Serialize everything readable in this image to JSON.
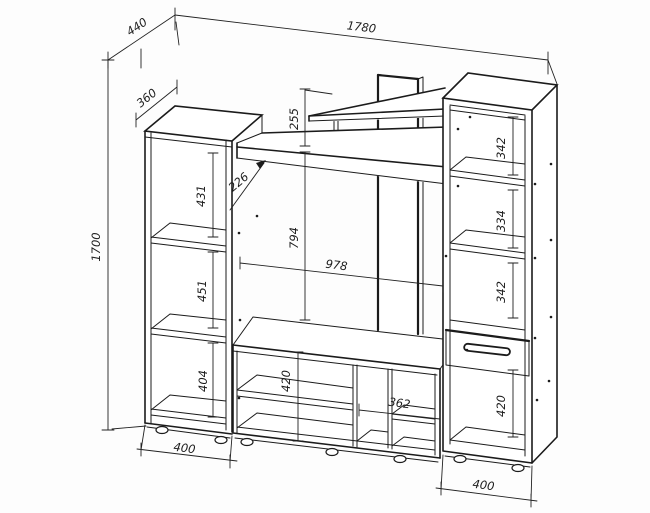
{
  "drawing": {
    "type": "furniture-assembly-dimension-drawing",
    "units": "mm",
    "line_color": "#1b1b1b",
    "background": "#fdfdfd",
    "dims": {
      "overall_width": "1780",
      "overall_depth": "440",
      "overall_height": "1700",
      "left_top_depth": "360",
      "left_shelf_1": "431",
      "left_shelf_2": "451",
      "left_shelf_3": "404",
      "left_base_width": "400",
      "shelf_gap": "255",
      "shelf_depth": "226",
      "tv_opening_height": "794",
      "tv_opening_width": "978",
      "stand_inner_height": "420",
      "stand_right_width": "362",
      "right_shelf_1": "342",
      "right_shelf_2": "334",
      "right_shelf_3": "342",
      "right_bottom_section": "420",
      "right_base_width": "400"
    }
  }
}
